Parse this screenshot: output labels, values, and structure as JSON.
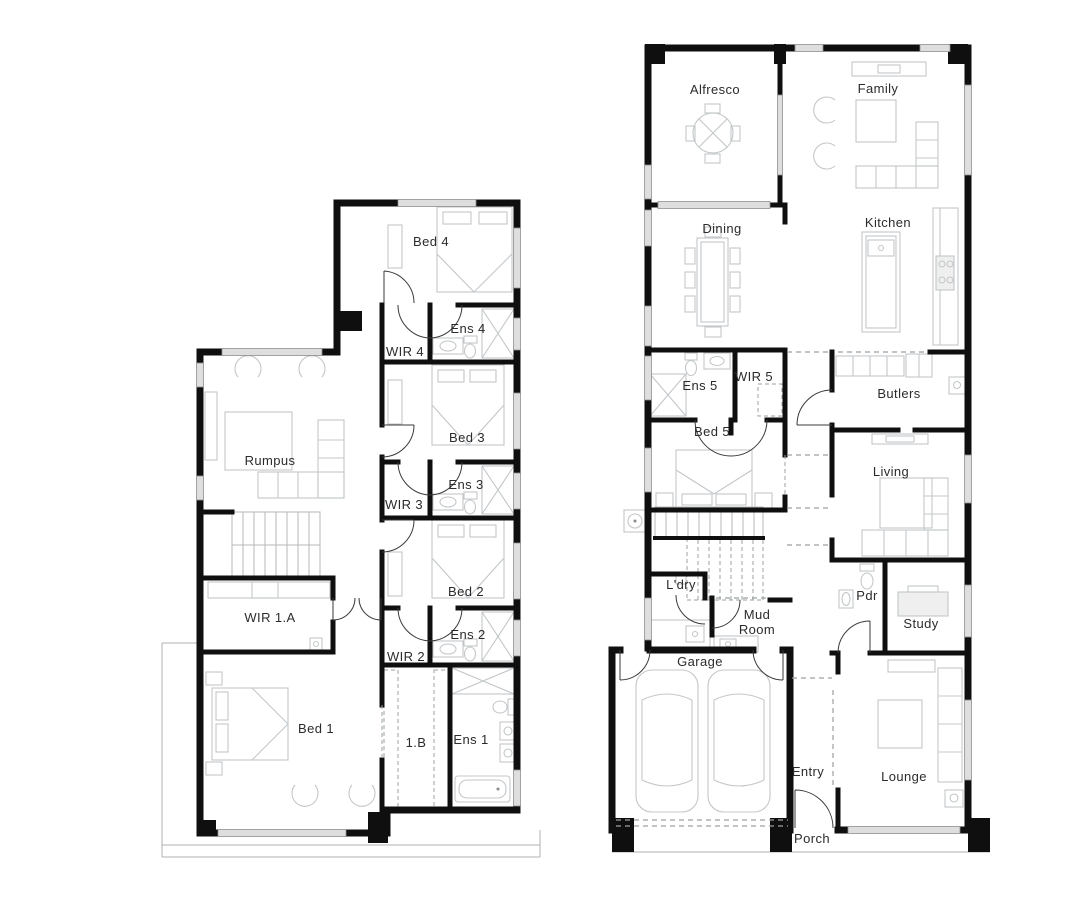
{
  "document": {
    "type": "floor-plan-drawing",
    "background": "#ffffff"
  },
  "colors": {
    "wall": "#0f0f0f",
    "window_fill": "#dedede",
    "furniture": "#c3c7c9",
    "label": "#2b2b2b",
    "dashed_line": "#9aa0a3"
  },
  "rooms": {
    "upper": {
      "bed4": "Bed 4",
      "ens4": "Ens 4",
      "wir4": "WIR 4",
      "bed3": "Bed 3",
      "ens3": "Ens 3",
      "wir3": "WIR 3",
      "bed2": "Bed 2",
      "ens2": "Ens 2",
      "wir2": "WIR 2",
      "rumpus": "Rumpus",
      "wir1a": "WIR 1.A",
      "bed1": "Bed 1",
      "wir1b": "1.B",
      "ens1": "Ens 1"
    },
    "ground": {
      "alfresco": "Alfresco",
      "family": "Family",
      "dining": "Dining",
      "kitchen": "Kitchen",
      "ens5": "Ens 5",
      "wir5": "WIR 5",
      "bed5": "Bed 5",
      "butlers": "Butlers",
      "living": "Living",
      "laundry": "L'dry",
      "mud_line1": "Mud",
      "mud_line2": "Room",
      "pdr": "Pdr",
      "study": "Study",
      "garage": "Garage",
      "entry": "Entry",
      "lounge": "Lounge",
      "porch": "Porch"
    }
  }
}
